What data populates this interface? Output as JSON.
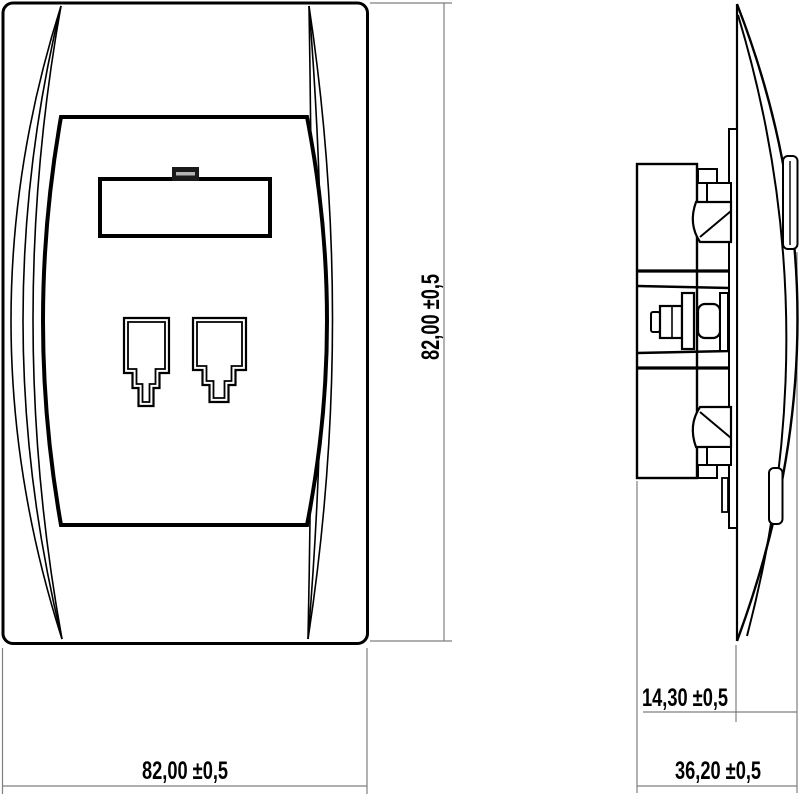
{
  "drawing": {
    "type": "technical-dimension-drawing",
    "subject": "double telephone/network wall socket (front view and side profile view)",
    "views": {
      "front": "socket front plate with label window and two RJ jack openings",
      "side": "socket profile with mounting claws, screw and support frame"
    },
    "dimensions": {
      "front_width_label": "82,00 ±0,5",
      "front_height_label": "82,00 ±0,5",
      "side_protrusion_label": "14,30 ±0,5",
      "side_depth_label": "36,20 ±0,5"
    },
    "colors": {
      "line": "#000000",
      "dimension_line": "#7f7f7f",
      "background": "#ffffff"
    }
  }
}
